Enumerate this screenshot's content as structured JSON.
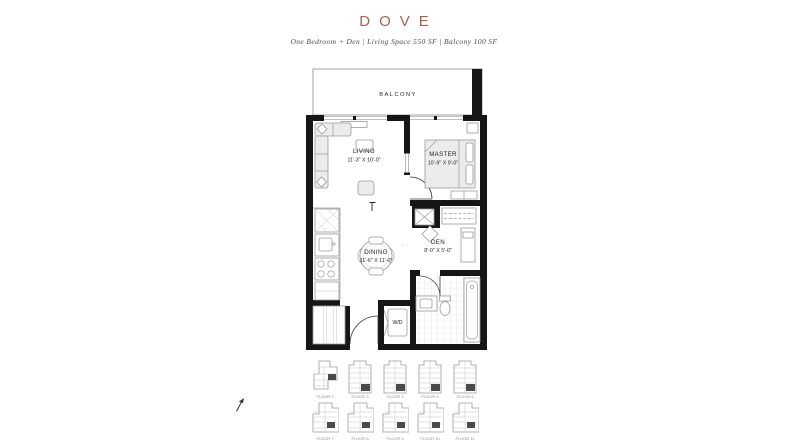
{
  "header": {
    "title": "DOVE",
    "subtitle": "One Bedroom + Den  |  Living Space 550 SF  |  Balcony 100 SF"
  },
  "floorplan": {
    "balcony": {
      "label": "BALCONY"
    },
    "living": {
      "label": "LIVING",
      "dims": "11'-3\" X 10'-0\""
    },
    "master": {
      "label": "MASTER",
      "dims": "10'-9\" X 9'-0\""
    },
    "den": {
      "label": "DEN",
      "dims": "8'-0\" X 5'-0\""
    },
    "dining": {
      "label": "DINING",
      "dims": "11'-6\" X 11'-0\""
    },
    "laundry": {
      "label": "W/D"
    }
  },
  "keyplans": {
    "items": [
      {
        "caption": "FLOOR 2"
      },
      {
        "caption": "FLOOR 3"
      },
      {
        "caption": "FLOOR 4"
      },
      {
        "caption": "FLOOR 5"
      },
      {
        "caption": "FLOOR 6"
      },
      {
        "caption": "FLOOR 7"
      },
      {
        "caption": "FLOOR 8"
      },
      {
        "caption": "FLOOR 9"
      },
      {
        "caption": "FLOOR 10"
      },
      {
        "caption": "FLOOR 11"
      }
    ]
  },
  "colors": {
    "accent": "#a8604f",
    "wall": "#161616",
    "line": "#9a9a9a",
    "text": "#1e1e1e"
  }
}
